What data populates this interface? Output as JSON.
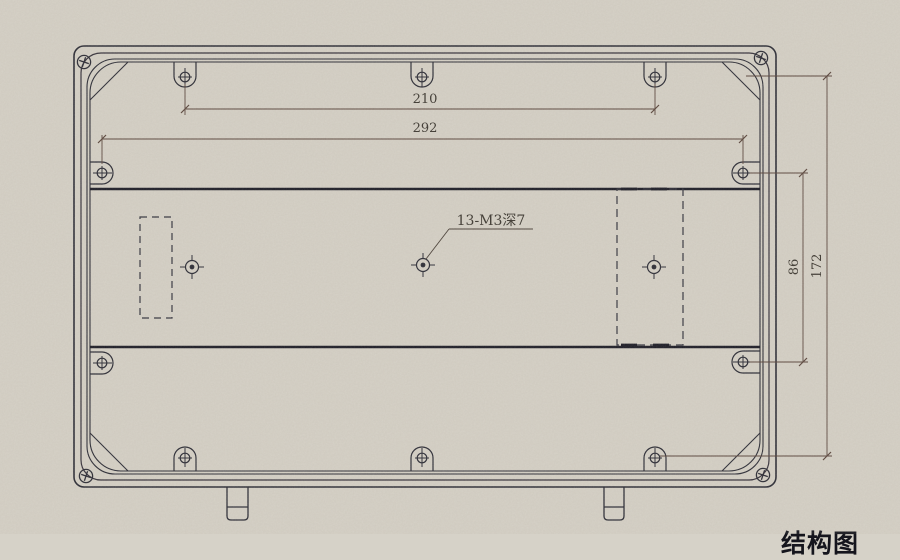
{
  "drawing": {
    "type": "engineering-drawing",
    "view": "enclosure-back-panel-inside-view",
    "dimensions": {
      "top_hole_span": "210",
      "side_hole_span": "292",
      "right_inner_span": "86",
      "right_outer_span": "172"
    },
    "callout": {
      "hole_spec": "13-M3深7"
    },
    "caption_partial": "结构图"
  },
  "colors": {
    "paper": "#d6d2c8",
    "ink": "#2b2b35",
    "band": "#1b1b25",
    "dim": "#5a453c",
    "dim-text": "#3c3730"
  }
}
